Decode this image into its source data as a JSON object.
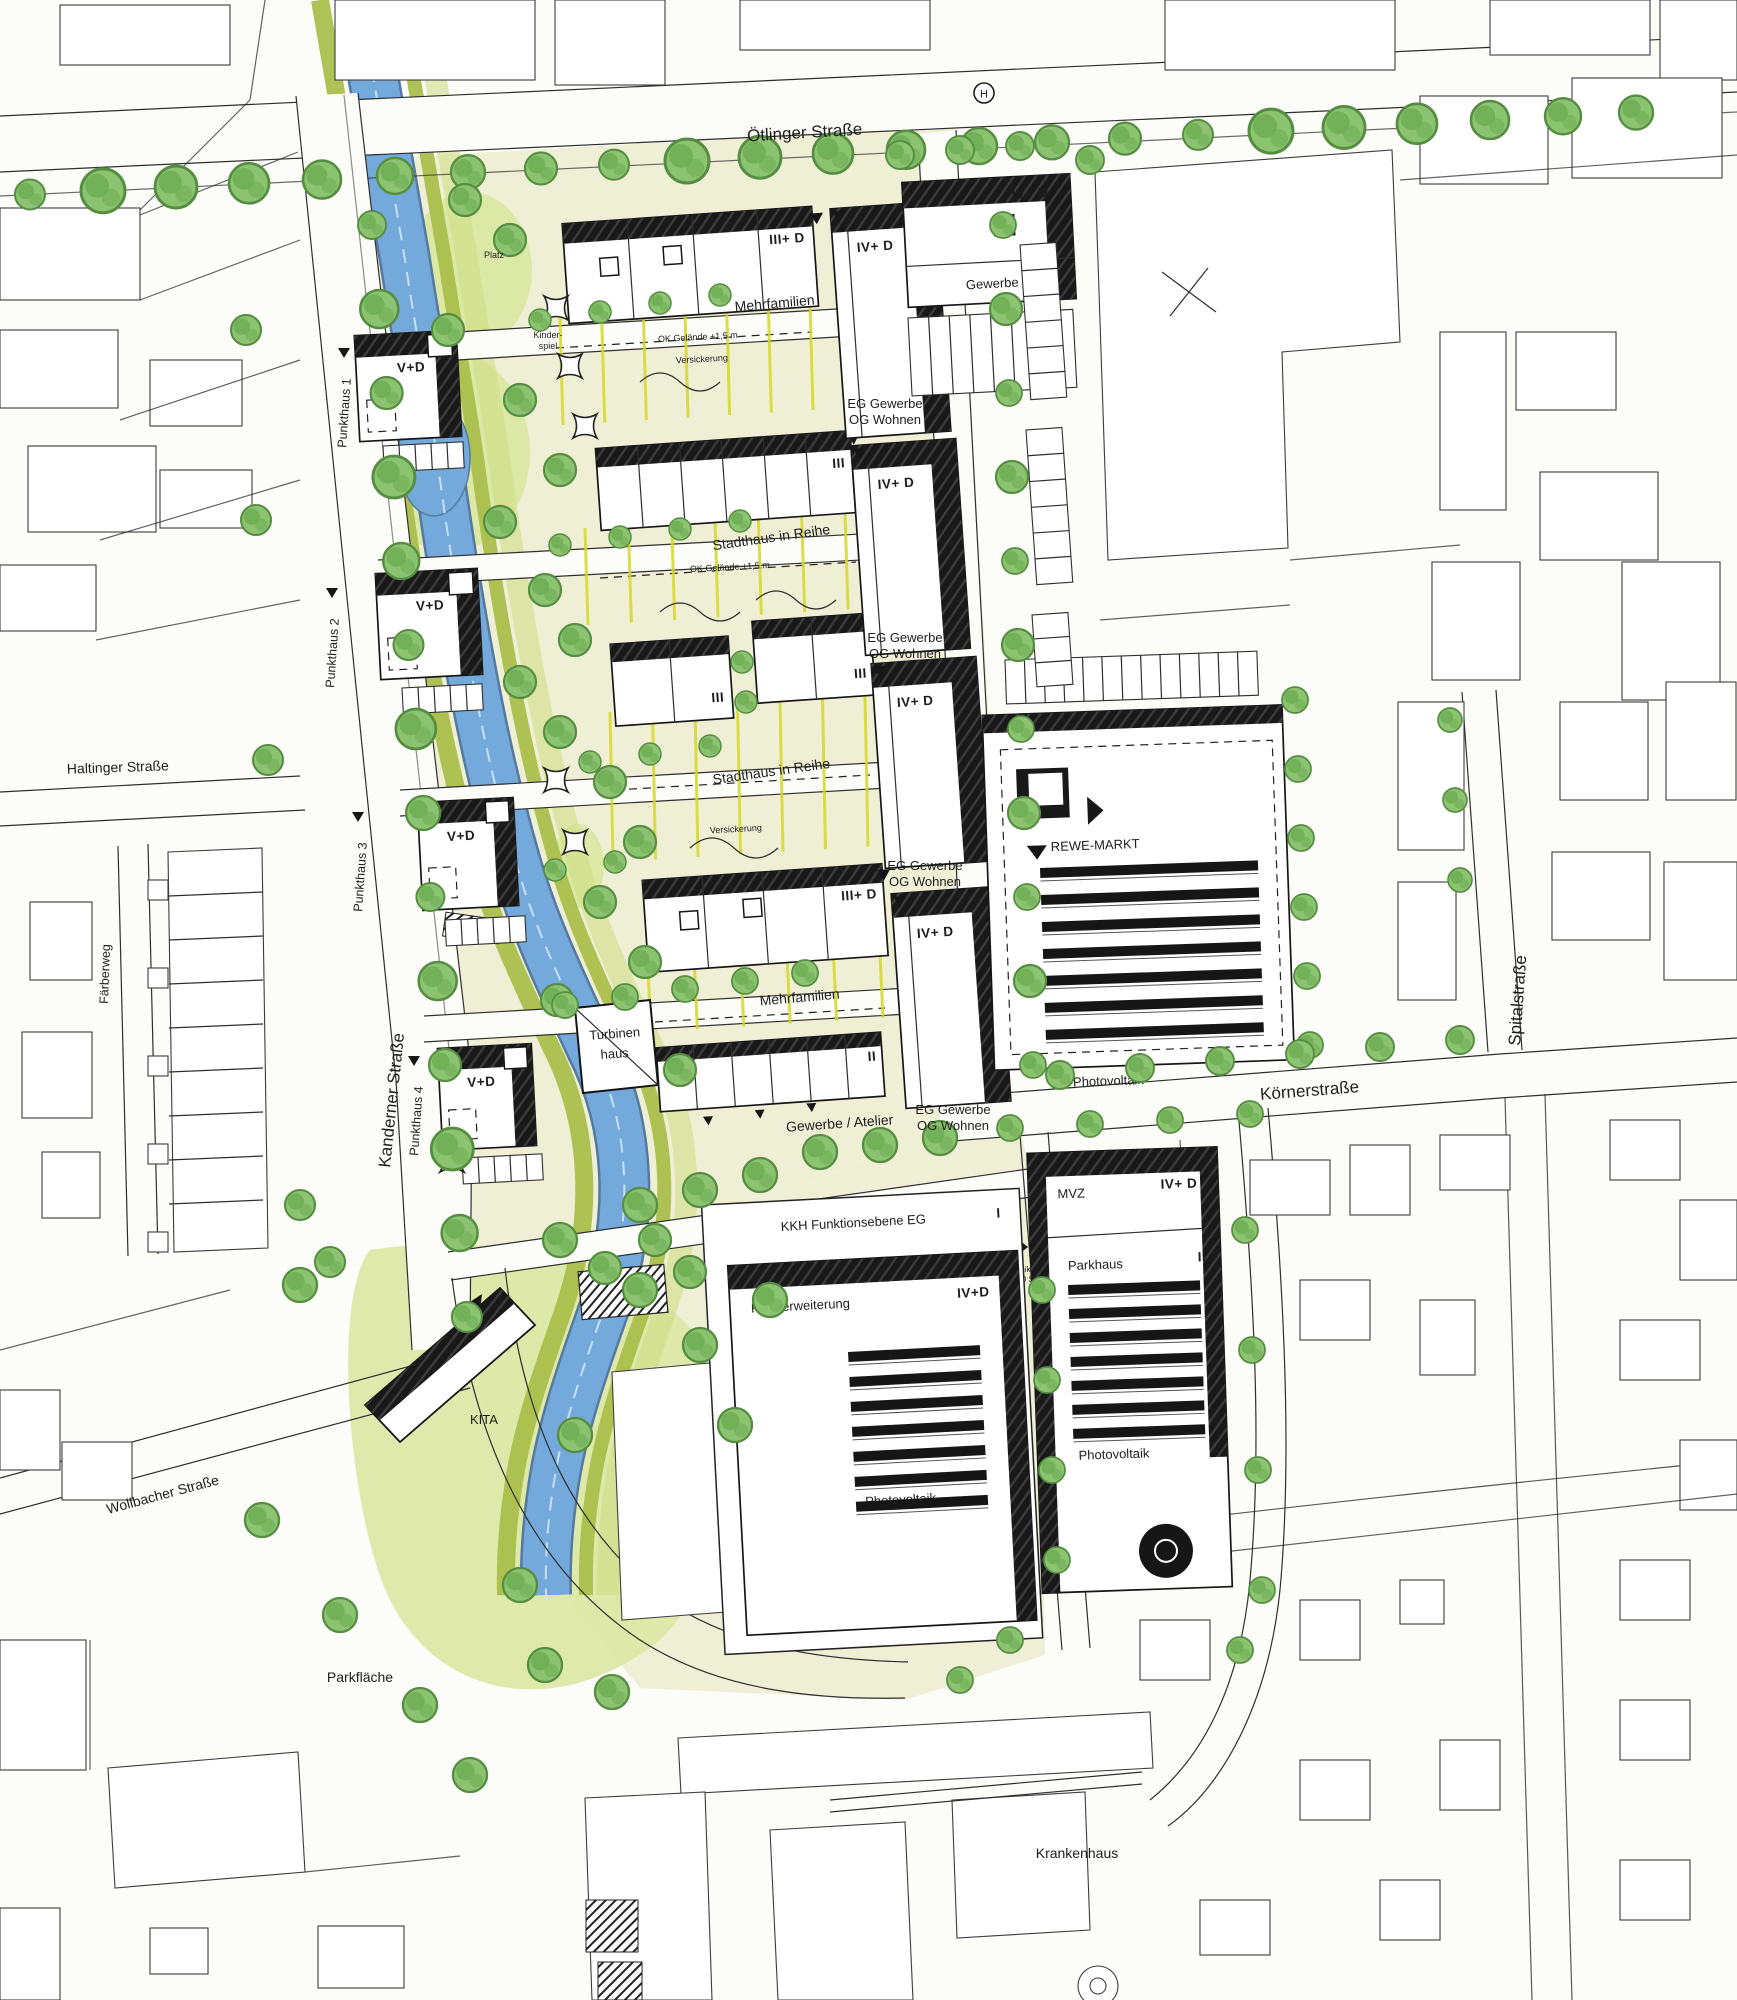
{
  "colors": {
    "paper": "#fcfcf9",
    "river": "#74a9db",
    "river_edge": "#55799f",
    "river_squiggle": "#cfe6f6",
    "park": "#efefd6",
    "lawn": "#dce8a6",
    "olive": "#aabf4c",
    "stripe": "#d4d829",
    "tree_fill": "#8cc371",
    "tree_core": "#6fae55",
    "tree_edge": "#558e41",
    "ink": "#1d1d1d",
    "shadow": "#1b1b1b"
  },
  "streets": {
    "otlinger": "Ötlinger Straße",
    "kanderner": "Kanderner Straße",
    "koerner": "Körnerstraße",
    "spital": "Spitalstraße",
    "haltinger": "Haltinger Straße",
    "faerberweg": "Färberweg",
    "wollbacher": "Wollbacher Straße"
  },
  "areas": {
    "platz": "Platz",
    "kinderspiel_1": "Kinder-",
    "kinderspiel_2": "spiel",
    "parkflaeche": "Parkfläche",
    "kita": "KITA",
    "krankenhaus": "Krankenhaus"
  },
  "buildings": {
    "mehrfamilien": "Mehrfamilien",
    "stadthaus": "Stadthaus in Reihe",
    "eg_gewerbe": "EG Gewerbe",
    "og_wohnen": "OG Wohnen",
    "gewerbe": "Gewerbe",
    "gewerbe_atelier": "Gewerbe / Atelier",
    "turbinen_1": "Turbinen",
    "turbinen_2": "haus",
    "rewe": "REWE-MARKT",
    "photovoltaik": "Photovoltaik",
    "mvz": "MVZ",
    "parkhaus": "Parkhaus",
    "kkh": "KKH Funktionsebene EG",
    "klinikerweiterung": "Klinikerweiterung",
    "punkthaus_1": "Punkthaus 1",
    "punkthaus_2": "Punkthaus 2",
    "punkthaus_3": "Punkthaus 3",
    "punkthaus_4": "Punkthaus 4"
  },
  "heights": {
    "v_d": "V+D",
    "iv_d": "IV+ D",
    "iv_d_compact": "IV+D",
    "iii_d": "III+ D",
    "iii": "III",
    "ii": "II",
    "i": "I"
  },
  "annotations": {
    "ok_gelaende": "OK Gelände +1,5 m",
    "versickerung": "Versickerung",
    "tg_1": "TG Klinik -II",
    "tg_2": "ca. 120 Stp",
    "bus_stop": "H"
  }
}
